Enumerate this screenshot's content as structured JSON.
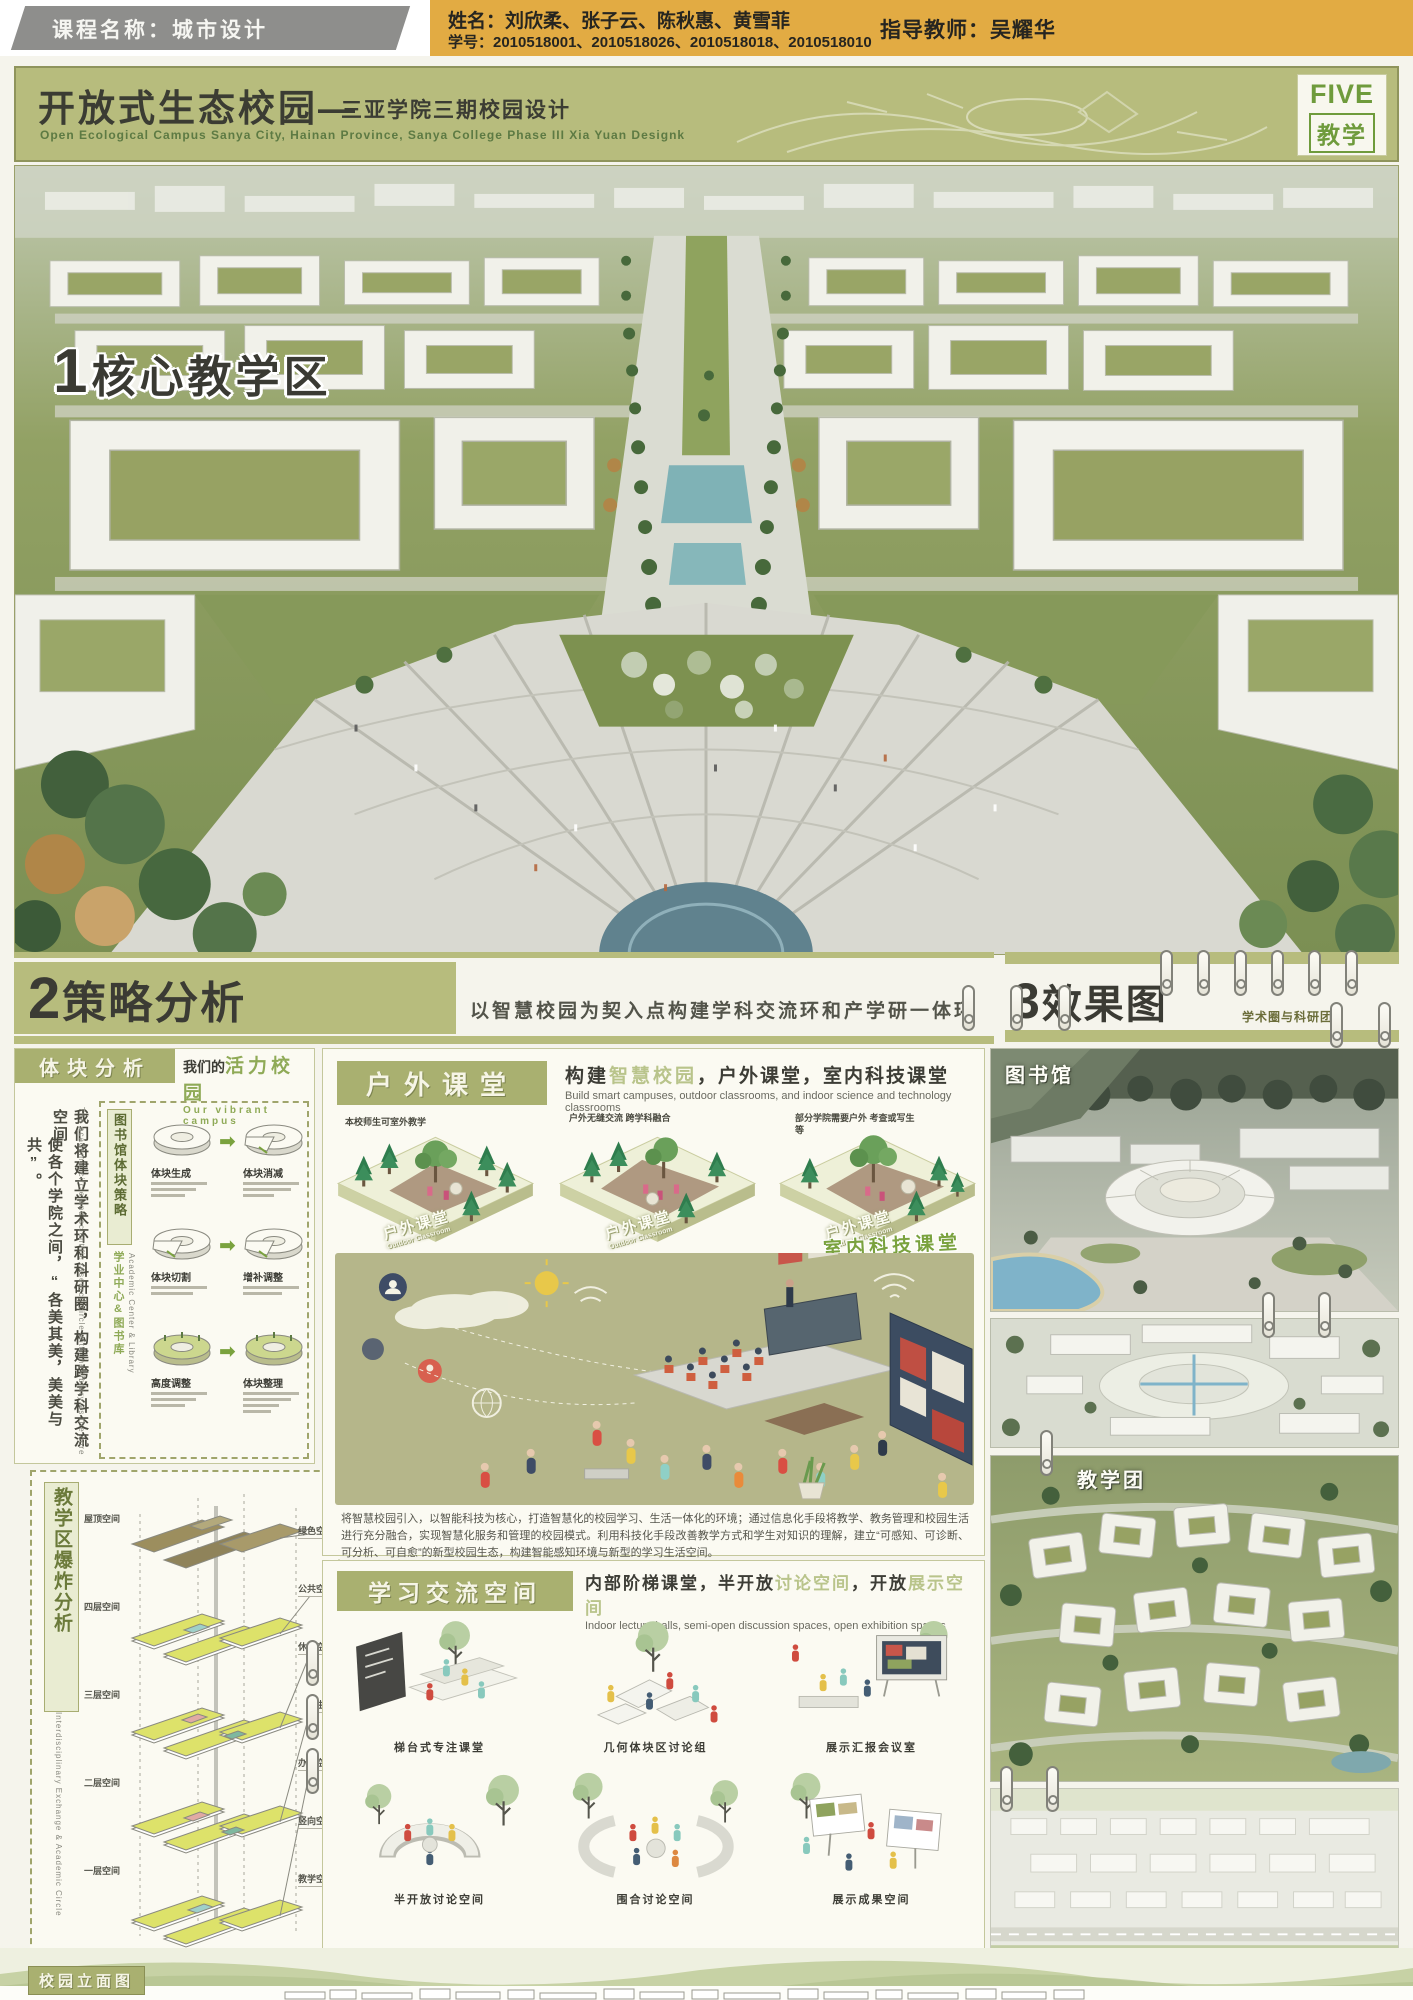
{
  "header": {
    "course": "课程名称：城市设计",
    "names": "姓名：刘欣柔、张子云、陈秋惠、黄雪菲",
    "student_ids": "学号：2010518001、2010518026、2010518018、2010518010",
    "advisor": "指导教师：吴耀华"
  },
  "titlebar": {
    "title_cn": "开放式生态校园—",
    "subtitle_cn": "三亚学院三期校园设计",
    "subtitle_en": "Open Ecological Campus Sanya City, Hainan Province, Sanya College Phase III Xia Yuan Designk",
    "badge_line1": "FIVE",
    "badge_line2": "教学"
  },
  "sections": {
    "s1_num": "1",
    "s1": "核心教学区",
    "s2_num": "2",
    "s2": "策略分析",
    "s2_sub": "以智慧校园为契入点构建学科交流环和产学研一体环",
    "s3_num": "3",
    "s3": "效果图",
    "s3_sub": "学术圈与科研团"
  },
  "massing": {
    "header": "体块分析",
    "vibrant_a": "我们的",
    "vibrant_b": "活力校园",
    "vibrant_en": "Our vibrant campus",
    "para_cn_1": "我们将建立学术环和科研圈，构建跨学科交流空间",
    "para_cn_2": "使各个学院之间，“各美其美，美美与共”。",
    "para_en": "The academic circle and scientific research circle with the library as the core",
    "strategy_label": "图书馆体块策略",
    "center_cn": "学业中心&图书库",
    "center_en": "Academic Center & Library",
    "steps": [
      "体块生成",
      "体块消减",
      "体块切割",
      "增补调整",
      "高度调整",
      "体块整理"
    ]
  },
  "explode": {
    "title": "教学区爆炸分析",
    "title_en": "Interdisciplinary Exchange & Academic Circle",
    "floors": [
      "屋顶空间",
      "四层空间",
      "三层空间",
      "二层空间",
      "一层空间"
    ],
    "legend": [
      "绿色空间",
      "公共空间",
      "休闲空间",
      "卫生间",
      "办公空间",
      "竖向空间",
      "教学空间"
    ]
  },
  "outdoor": {
    "header": "户外课堂",
    "sub_a": "构建",
    "sub_b": "智慧校园",
    "sub_c": "，户外课堂，室内科技课堂",
    "subtitle_en": "Build smart campuses, outdoor classrooms, and indoor science and technology classrooms",
    "note_1": "本校师生可室外教学",
    "note_2": "户外无缝交流 跨学科融合",
    "note_3": "部分学院需要户外 考查或写生等",
    "tile_label": "户外课堂",
    "tile_label_en": "Outdoor Classroom",
    "indoor_label": "室内科技课堂",
    "paragraph": "将智慧校园引入，以智能科技为核心，打造智慧化的校园学习、生活一体化的环境；通过信息化手段将教学、教务管理和校园生活进行充分融合，实现智慧化服务和管理的校园模式。利用科技化手段改善教学方式和学生对知识的理解，建立“可感知、可诊断、可分析、可自愈”的新型校园生态，构建智能感知环境与新型的学习生活空间。"
  },
  "learning": {
    "header": "学习交流空间",
    "sub_a": "内部阶梯课堂，半开放",
    "sub_b": "讨论空间",
    "sub_c": "，开放",
    "sub_d": "展示空间",
    "subtitle_en": "Indoor lecture halls, semi-open discussion spaces, open exhibition spaces",
    "captions": [
      "梯台式专注课堂",
      "几何体块区讨论组",
      "展示汇报会议室",
      "半开放讨论空间",
      "围合讨论空间",
      "展示成果空间"
    ]
  },
  "renders": {
    "library_label": "图书馆",
    "teaching_label": "教学团"
  },
  "footer": {
    "elevation_label": "校园立面图"
  },
  "colors": {
    "sage": "#b7bc7d",
    "olive_header": "#a9b070",
    "mustard": "#e2ab43",
    "accent_green": "#8faa57",
    "ink": "#3b3c33"
  }
}
